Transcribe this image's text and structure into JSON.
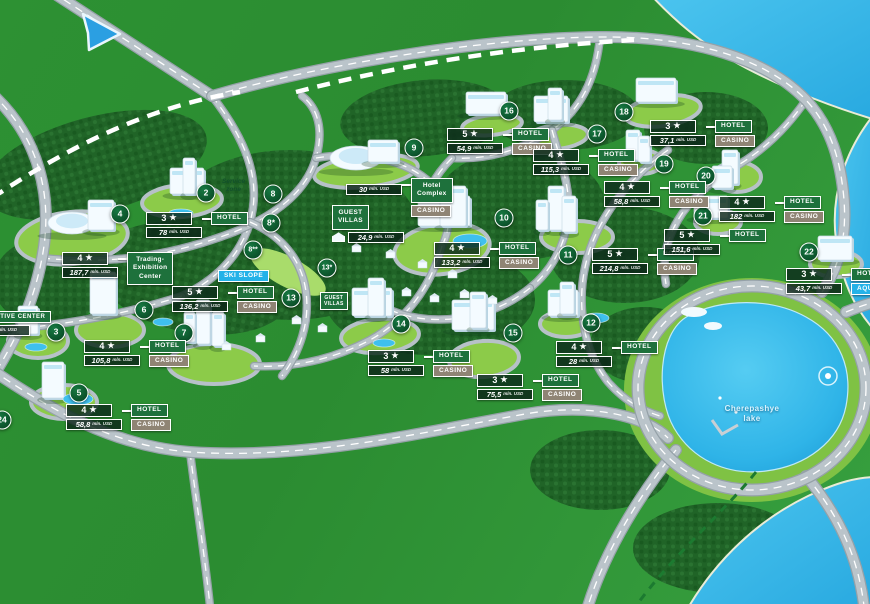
{
  "map": {
    "unit": "mln. USD",
    "lake_label": {
      "line1": "Cherepashye",
      "line2": "lake"
    },
    "service_zone": "Service\nzone",
    "colors": {
      "grass": "#2d9133",
      "forest": "#206427",
      "site_pad": "#8ccb49",
      "road": "#bac4ca",
      "water": "#35b5e9",
      "marker": "#0b5029",
      "hotel_tag": "#1e713c",
      "casino_tag": "#8f8474",
      "aqua_tag": "#24b2e8"
    },
    "markers": [
      {
        "num": "2",
        "x": 206,
        "y": 193
      },
      {
        "num": "3",
        "x": 56,
        "y": 332
      },
      {
        "num": "4",
        "x": 120,
        "y": 214
      },
      {
        "num": "5",
        "x": 79,
        "y": 393
      },
      {
        "num": "6",
        "x": 144,
        "y": 310
      },
      {
        "num": "7",
        "x": 184,
        "y": 333
      },
      {
        "num": "8",
        "x": 273,
        "y": 194
      },
      {
        "num": "8*",
        "x": 271,
        "y": 223
      },
      {
        "num": "8**",
        "x": 253,
        "y": 250
      },
      {
        "num": "9",
        "x": 414,
        "y": 148
      },
      {
        "num": "10",
        "x": 504,
        "y": 218
      },
      {
        "num": "11",
        "x": 568,
        "y": 255
      },
      {
        "num": "12",
        "x": 591,
        "y": 323
      },
      {
        "num": "13",
        "x": 291,
        "y": 298
      },
      {
        "num": "13*",
        "x": 327,
        "y": 268
      },
      {
        "num": "14",
        "x": 401,
        "y": 324
      },
      {
        "num": "15",
        "x": 513,
        "y": 333
      },
      {
        "num": "16",
        "x": 509,
        "y": 111
      },
      {
        "num": "17",
        "x": 597,
        "y": 134
      },
      {
        "num": "18",
        "x": 624,
        "y": 112
      },
      {
        "num": "19",
        "x": 664,
        "y": 164
      },
      {
        "num": "20",
        "x": 706,
        "y": 176
      },
      {
        "num": "21",
        "x": 703,
        "y": 216
      },
      {
        "num": "22",
        "x": 809,
        "y": 252
      },
      {
        "num": "24",
        "x": 2,
        "y": 420
      }
    ],
    "label_groups": [
      {
        "id": "2",
        "x": 146,
        "y": 212,
        "left": [
          [
            "stars",
            "3"
          ],
          [
            "value",
            "78"
          ]
        ],
        "right": [
          [
            "hotel",
            "HOTEL"
          ]
        ]
      },
      {
        "id": "3",
        "x": -48,
        "y": 311,
        "indent2": 22,
        "left": [
          [
            "admin",
            "ADMINISTRATIVE CENTER"
          ],
          [
            "value",
            "73"
          ]
        ],
        "right": []
      },
      {
        "id": "4",
        "x": 62,
        "y": 252,
        "left": [
          [
            "stars",
            "4"
          ],
          [
            "value",
            "187,7"
          ]
        ],
        "right": [
          [
            "name",
            "Trading-\nExhibition\nCenter"
          ]
        ]
      },
      {
        "id": "5",
        "x": 66,
        "y": 404,
        "left": [
          [
            "stars",
            "4"
          ],
          [
            "value",
            "58,8"
          ]
        ],
        "right": [
          [
            "hotel",
            "HOTEL"
          ],
          [
            "casino",
            "CASINO"
          ]
        ]
      },
      {
        "id": "6",
        "x": 84,
        "y": 340,
        "left": [
          [
            "stars",
            "4"
          ],
          [
            "value",
            "105,8"
          ]
        ],
        "right": [
          [
            "hotel",
            "HOTEL"
          ],
          [
            "casino",
            "CASINO"
          ]
        ]
      },
      {
        "id": "7",
        "x": 172,
        "y": 286,
        "left": [
          [
            "stars",
            "5"
          ],
          [
            "value",
            "136,2"
          ]
        ],
        "right": [
          [
            "hotel",
            "HOTEL"
          ],
          [
            "casino",
            "CASINO"
          ]
        ]
      },
      {
        "id": "9",
        "x": 346,
        "y": 178,
        "valueTop": 6,
        "left": [
          [
            "value",
            "30"
          ]
        ],
        "right": [
          [
            "name",
            "Hotel\nComplex"
          ],
          [
            "casino",
            "CASINO"
          ]
        ]
      },
      {
        "id": "10",
        "x": 434,
        "y": 242,
        "left": [
          [
            "stars",
            "4"
          ],
          [
            "value",
            "133,2"
          ]
        ],
        "right": [
          [
            "hotel",
            "HOTEL"
          ],
          [
            "casino",
            "CASINO"
          ]
        ]
      },
      {
        "id": "11",
        "x": 592,
        "y": 248,
        "left": [
          [
            "stars",
            "5"
          ],
          [
            "value",
            "214,8"
          ]
        ],
        "right": [
          [
            "hotel",
            "HOTEL"
          ],
          [
            "casino",
            "CASINO"
          ]
        ]
      },
      {
        "id": "12",
        "x": 556,
        "y": 341,
        "left": [
          [
            "stars",
            "4"
          ],
          [
            "value",
            "28"
          ]
        ],
        "right": [
          [
            "hotel",
            "HOTEL"
          ]
        ]
      },
      {
        "id": "14",
        "x": 368,
        "y": 350,
        "left": [
          [
            "stars",
            "3"
          ],
          [
            "value",
            "58"
          ]
        ],
        "right": [
          [
            "hotel",
            "HOTEL"
          ],
          [
            "casino",
            "CASINO"
          ]
        ]
      },
      {
        "id": "15",
        "x": 477,
        "y": 374,
        "left": [
          [
            "stars",
            "3"
          ],
          [
            "value",
            "75,5"
          ]
        ],
        "right": [
          [
            "hotel",
            "HOTEL"
          ],
          [
            "casino",
            "CASINO"
          ]
        ]
      },
      {
        "id": "16",
        "x": 447,
        "y": 128,
        "left": [
          [
            "stars",
            "5"
          ],
          [
            "value",
            "54,9"
          ]
        ],
        "right": [
          [
            "hotel",
            "HOTEL"
          ],
          [
            "casino",
            "CASINO"
          ]
        ]
      },
      {
        "id": "17",
        "x": 533,
        "y": 149,
        "left": [
          [
            "stars",
            "4"
          ],
          [
            "value",
            "115,3"
          ]
        ],
        "right": [
          [
            "hotel",
            "HOTEL"
          ],
          [
            "casino",
            "CASINO"
          ]
        ]
      },
      {
        "id": "18",
        "x": 650,
        "y": 120,
        "left": [
          [
            "stars",
            "3"
          ],
          [
            "value",
            "37,1"
          ]
        ],
        "right": [
          [
            "hotel",
            "HOTEL"
          ],
          [
            "casino",
            "CASINO"
          ]
        ]
      },
      {
        "id": "19",
        "x": 604,
        "y": 181,
        "left": [
          [
            "stars",
            "4"
          ],
          [
            "value",
            "58,8"
          ]
        ],
        "right": [
          [
            "hotel",
            "HOTEL"
          ],
          [
            "casino",
            "CASINO"
          ]
        ]
      },
      {
        "id": "20",
        "x": 719,
        "y": 196,
        "left": [
          [
            "stars",
            "4"
          ],
          [
            "value",
            "182"
          ]
        ],
        "right": [
          [
            "hotel",
            "HOTEL"
          ],
          [
            "casino",
            "CASINO"
          ]
        ]
      },
      {
        "id": "21",
        "x": 664,
        "y": 229,
        "left": [
          [
            "stars",
            "5"
          ],
          [
            "value",
            "151,6"
          ]
        ],
        "right": [
          [
            "hotel",
            "HOTEL"
          ]
        ]
      },
      {
        "id": "22",
        "x": 786,
        "y": 268,
        "left": [
          [
            "stars",
            "3"
          ],
          [
            "value",
            "43,7"
          ]
        ],
        "right": [
          [
            "hotel",
            "HOTEL"
          ],
          [
            "aqua",
            "AQUA PARK"
          ]
        ]
      },
      {
        "id": "guest-villas",
        "x": 332,
        "y": 205,
        "villaIcon": true,
        "left": [
          [
            "name",
            "GUEST\nVILLAS"
          ],
          [
            "value",
            "24,9"
          ]
        ],
        "right": []
      },
      {
        "id": "ski-slope",
        "x": 218,
        "y": 270,
        "left": [
          [
            "aqua",
            "SKI SLOPE"
          ]
        ],
        "right": []
      },
      {
        "id": "guest-villas-small",
        "x": 320,
        "y": 292,
        "left": [
          [
            "name-sm",
            "GUEST\nVILLAS"
          ]
        ],
        "right": []
      }
    ]
  }
}
